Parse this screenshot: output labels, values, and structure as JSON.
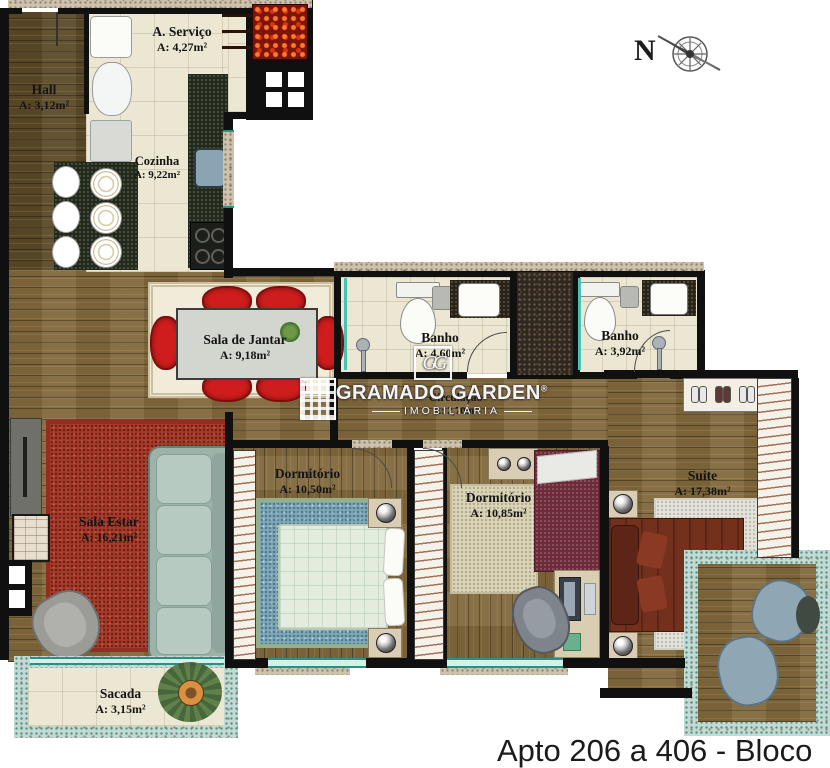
{
  "plan": {
    "caption": "Apto 206 a 406 - Bloco A",
    "compass": "N",
    "watermark": {
      "brand": "GRAMADO GARDEN",
      "registered": "®",
      "tagline": "IMOBILIÁRIA",
      "monogram": "GG"
    },
    "rooms": {
      "hall": {
        "name": "Hall",
        "area": "A: 3,12m²"
      },
      "servico": {
        "name": "A. Serviço",
        "area": "A: 4,27m²"
      },
      "cozinha": {
        "name": "Cozinha",
        "area": "A: 9,22m²"
      },
      "sala_jantar": {
        "name": "Sala de Jantar",
        "area": "A: 9,18m²"
      },
      "banho_1": {
        "name": "Banho",
        "area": "A: 4,60m²"
      },
      "banho_2": {
        "name": "Banho",
        "area": "A: 3,92m²"
      },
      "circulacao": {
        "name": "Circulação",
        "area": "A: 2,70m²"
      },
      "dormitorio_1": {
        "name": "Dormitório",
        "area": "A: 10,50m²"
      },
      "dormitorio_2": {
        "name": "Dormitório",
        "area": "A: 10,85m²"
      },
      "suite": {
        "name": "Suite",
        "area": "A: 17,38m²"
      },
      "sala_estar": {
        "name": "Sala Estar",
        "area": "A: 16,21m²"
      },
      "sacada": {
        "name": "Sacada",
        "area": "A: 3,15m²"
      }
    },
    "palette": {
      "wall": "#101010",
      "wood": "#82683c",
      "wood_dark": "#5c4a27",
      "tile_cream": "#ece7d2",
      "window_teal": "#259286",
      "exterior_speckle": "#cdc2ae",
      "balcony_speckle": "#c2dad3",
      "rug_red": "#a63a2b",
      "rug_blue": "#7ea8b8",
      "rug_beige": "#d9d3b8",
      "rug_white": "#e2e2da",
      "sofa": "#9db3aa",
      "dining_chair_red": "#cf1d1d",
      "bed_light": "#e3ecdf",
      "bed_maroon": "#6e2c3b",
      "bed_suite": "#73301d",
      "counter_dark": "#232a1d",
      "grill_red": "#7d1408"
    }
  }
}
